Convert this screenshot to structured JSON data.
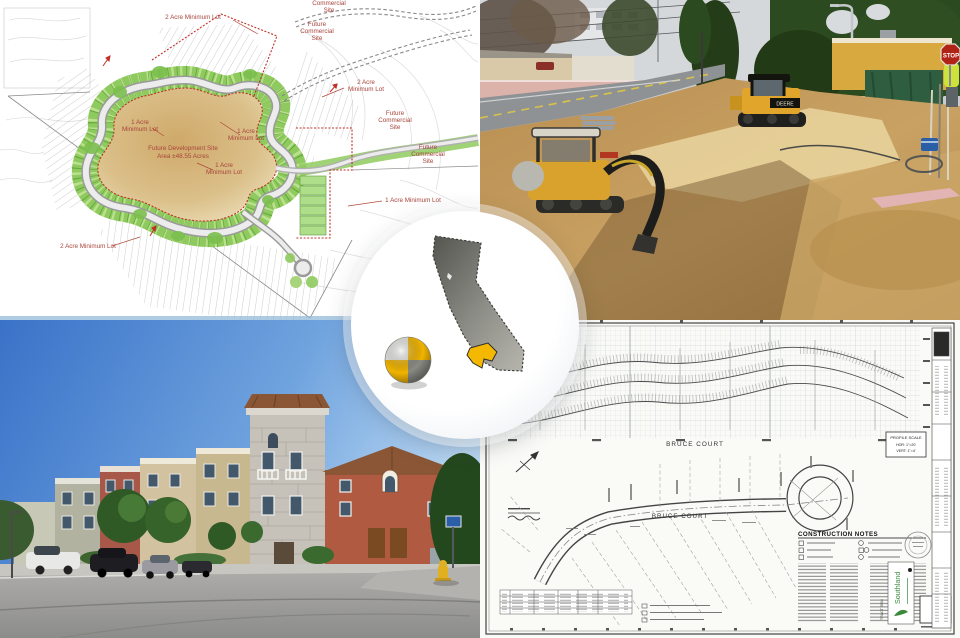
{
  "collage": {
    "description": "Land development collage: subdivision site plan, grading construction photo, completed townhomes street view, street improvement plan sheet, California location badge"
  },
  "site_plan": {
    "label_color": "#a8443a",
    "labels": {
      "top_2acre": "2 Acre Minimum Lot",
      "top_cut_line1": "Commercial",
      "top_cut_line2": "Site",
      "ne_comm_line1": "Future",
      "ne_comm_line2": "Commercial",
      "ne_comm_line3": "Site",
      "right_2acre_line1": "2 Acre",
      "right_2acre_line2": "Minimum Lot",
      "mid_comm_line1": "Future",
      "mid_comm_line2": "Commercial",
      "mid_comm_line3": "Site",
      "low_comm_line1": "Future",
      "low_comm_line2": "Commercial",
      "low_comm_line3": "Site",
      "left_1acre_line1": "1 Acre",
      "left_1acre_line2": "Minimum Lot",
      "ctr_1acre_a_line1": "1 Acre",
      "ctr_1acre_a_line2": "Minimum Lot",
      "dev_line1": "Future Development Site",
      "dev_line2": "Area ±48.55 Acres",
      "ctr_1acre_b_line1": "1 Acre",
      "ctr_1acre_b_line2": "Minimum Lot",
      "right_1acre": "1 Acre Minimum Lot",
      "bottom_2acre": "2 Acre Minimum Lot"
    }
  },
  "construction_photo": {
    "stop_sign": "STOP",
    "machine_brand": "DEERE"
  },
  "plan_sheet": {
    "street_profile": "BRUCE  COURT",
    "street_plan": "BRUCE   COURT",
    "profile_scale_title": "PROFILE SCALE",
    "profile_scale_hor": "HOR: 1\"=20'",
    "profile_scale_vert": "VERT: 1\"=4'",
    "notes_title": "CONSTRUCTION NOTES",
    "company": "Southland",
    "tract": "TRACT 5504",
    "sheet_number": "3"
  },
  "badge": {
    "state_icon": "california-silhouette",
    "highlight_icon": "county-highlight",
    "marker_icon": "survey-target-sphere",
    "state_fill_dark": "#62625e",
    "state_fill_light": "#a9a9a3",
    "county_highlight": "#f5b800"
  }
}
